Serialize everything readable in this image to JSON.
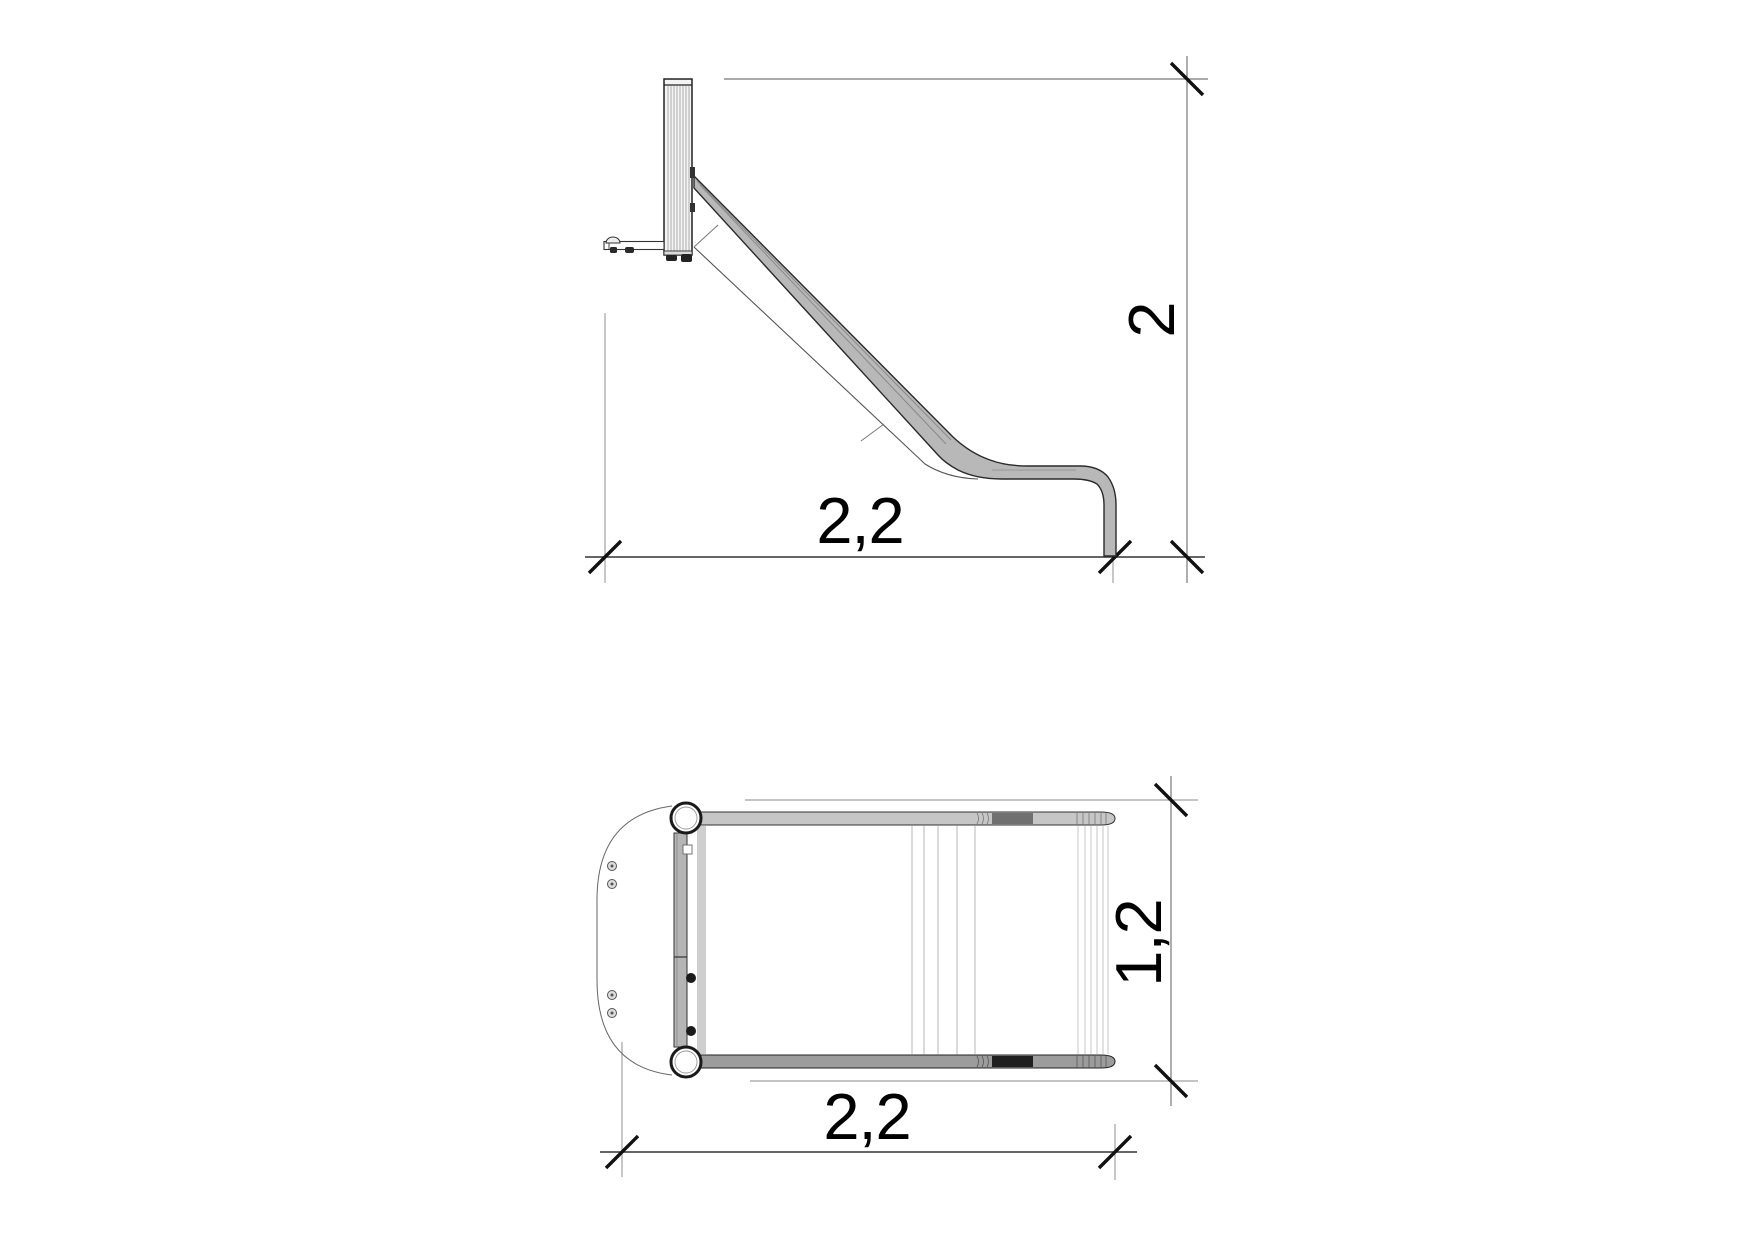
{
  "side_view": {
    "height_dim": "2",
    "length_dim": "2,2"
  },
  "plan_view": {
    "width_dim": "1,2",
    "length_dim": "2,2"
  },
  "colors": {
    "line": "#222222",
    "dim_line": "#666666",
    "extension_line": "#888888",
    "tick": "#111111",
    "chute_fill": "#b8b8b8",
    "rail_fill_light": "#c6c6c6",
    "rail_fill_mid": "#9c9c9c",
    "rail_fill_dark": "#1f1f1f",
    "background": "#ffffff"
  }
}
